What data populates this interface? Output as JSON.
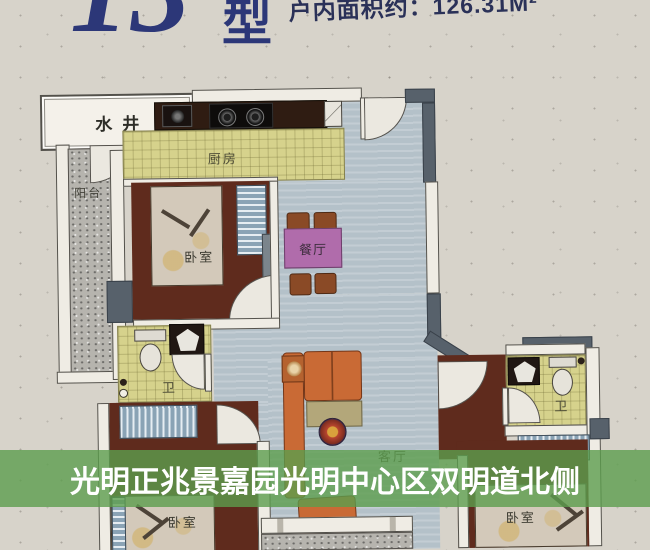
{
  "header": {
    "unit_number": "13",
    "unit_suffix": "型",
    "area_text": "户内面积约：126.31M²"
  },
  "floorplan": {
    "labels": {
      "water_well": "水井",
      "balcony": "阳台",
      "kitchen": "厨房",
      "bedroom_top": "卧室",
      "dining": "餐厅",
      "bath_left": "卫",
      "bath_right": "卫",
      "living": "客厅",
      "bedroom_bottom_left": "卧室",
      "bedroom_bottom_right": "卧室"
    }
  },
  "caption": {
    "text": "光明正兆景嘉园光明中心区双明道北侧"
  },
  "colors": {
    "header_blue": "#2c3778",
    "caption_green": "rgba(92,158,78,0.8)",
    "caption_text": "#ffffff",
    "floor_dark_red": "#5f2b1d",
    "tile_yellow": "#d6d28c",
    "floor_blue_gray": "#b4c1c9",
    "wall_dark": "#57616b",
    "paper": "#d7d3ca"
  }
}
